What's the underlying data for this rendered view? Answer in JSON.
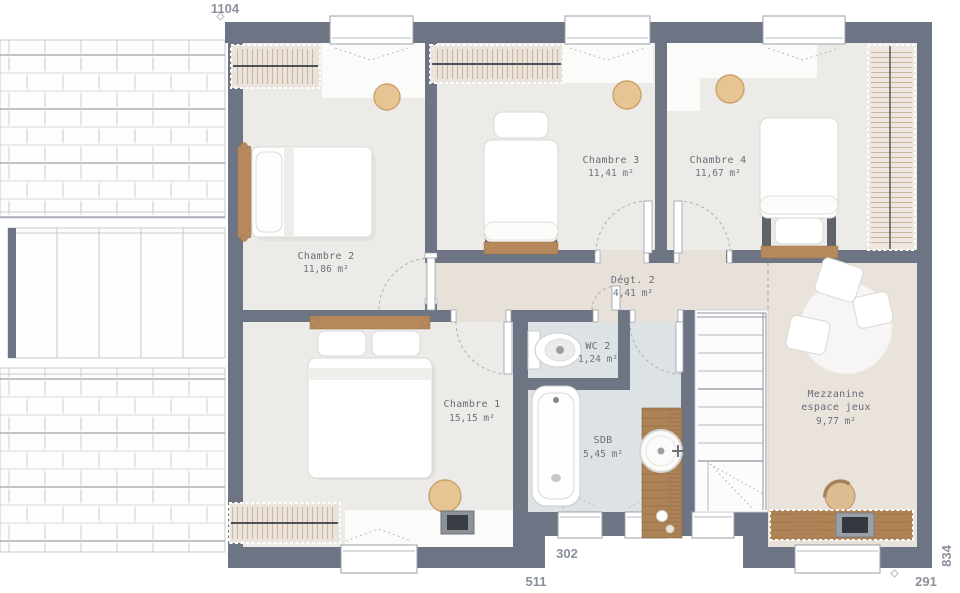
{
  "rooms": {
    "chambre1": {
      "name": "Chambre 1",
      "area": "15,15 m²"
    },
    "chambre2": {
      "name": "Chambre 2",
      "area": "11,86 m²"
    },
    "chambre3": {
      "name": "Chambre 3",
      "area": "11,41 m²"
    },
    "chambre4": {
      "name": "Chambre 4",
      "area": "11,67 m²"
    },
    "degagement": {
      "name": "Dégt. 2",
      "area": "4,41 m²"
    },
    "wc": {
      "name": "WC 2",
      "area": "1,24 m²"
    },
    "sdb": {
      "name": "SDB",
      "area": "5,45 m²"
    },
    "mezzanine": {
      "name": "Mezzanine",
      "subtitle": "espace jeux",
      "area": "9,77 m²"
    }
  },
  "dimensions": {
    "top_width": "1104",
    "recess_width": "302",
    "bottom_left_width": "511",
    "bottom_right_width": "291",
    "right_height": "834"
  },
  "colors": {
    "wall": "#6d7584",
    "bedroom_floor": "#edebe7",
    "hall_floor": "#e8e1da",
    "bathroom_floor": "#dde2e5",
    "mezzanine_floor": "#eae3dc",
    "wood": "#b5895c",
    "pouf_tan": "#e6c493",
    "label_text": "#666c75",
    "dimension_text": "#8b909b"
  }
}
